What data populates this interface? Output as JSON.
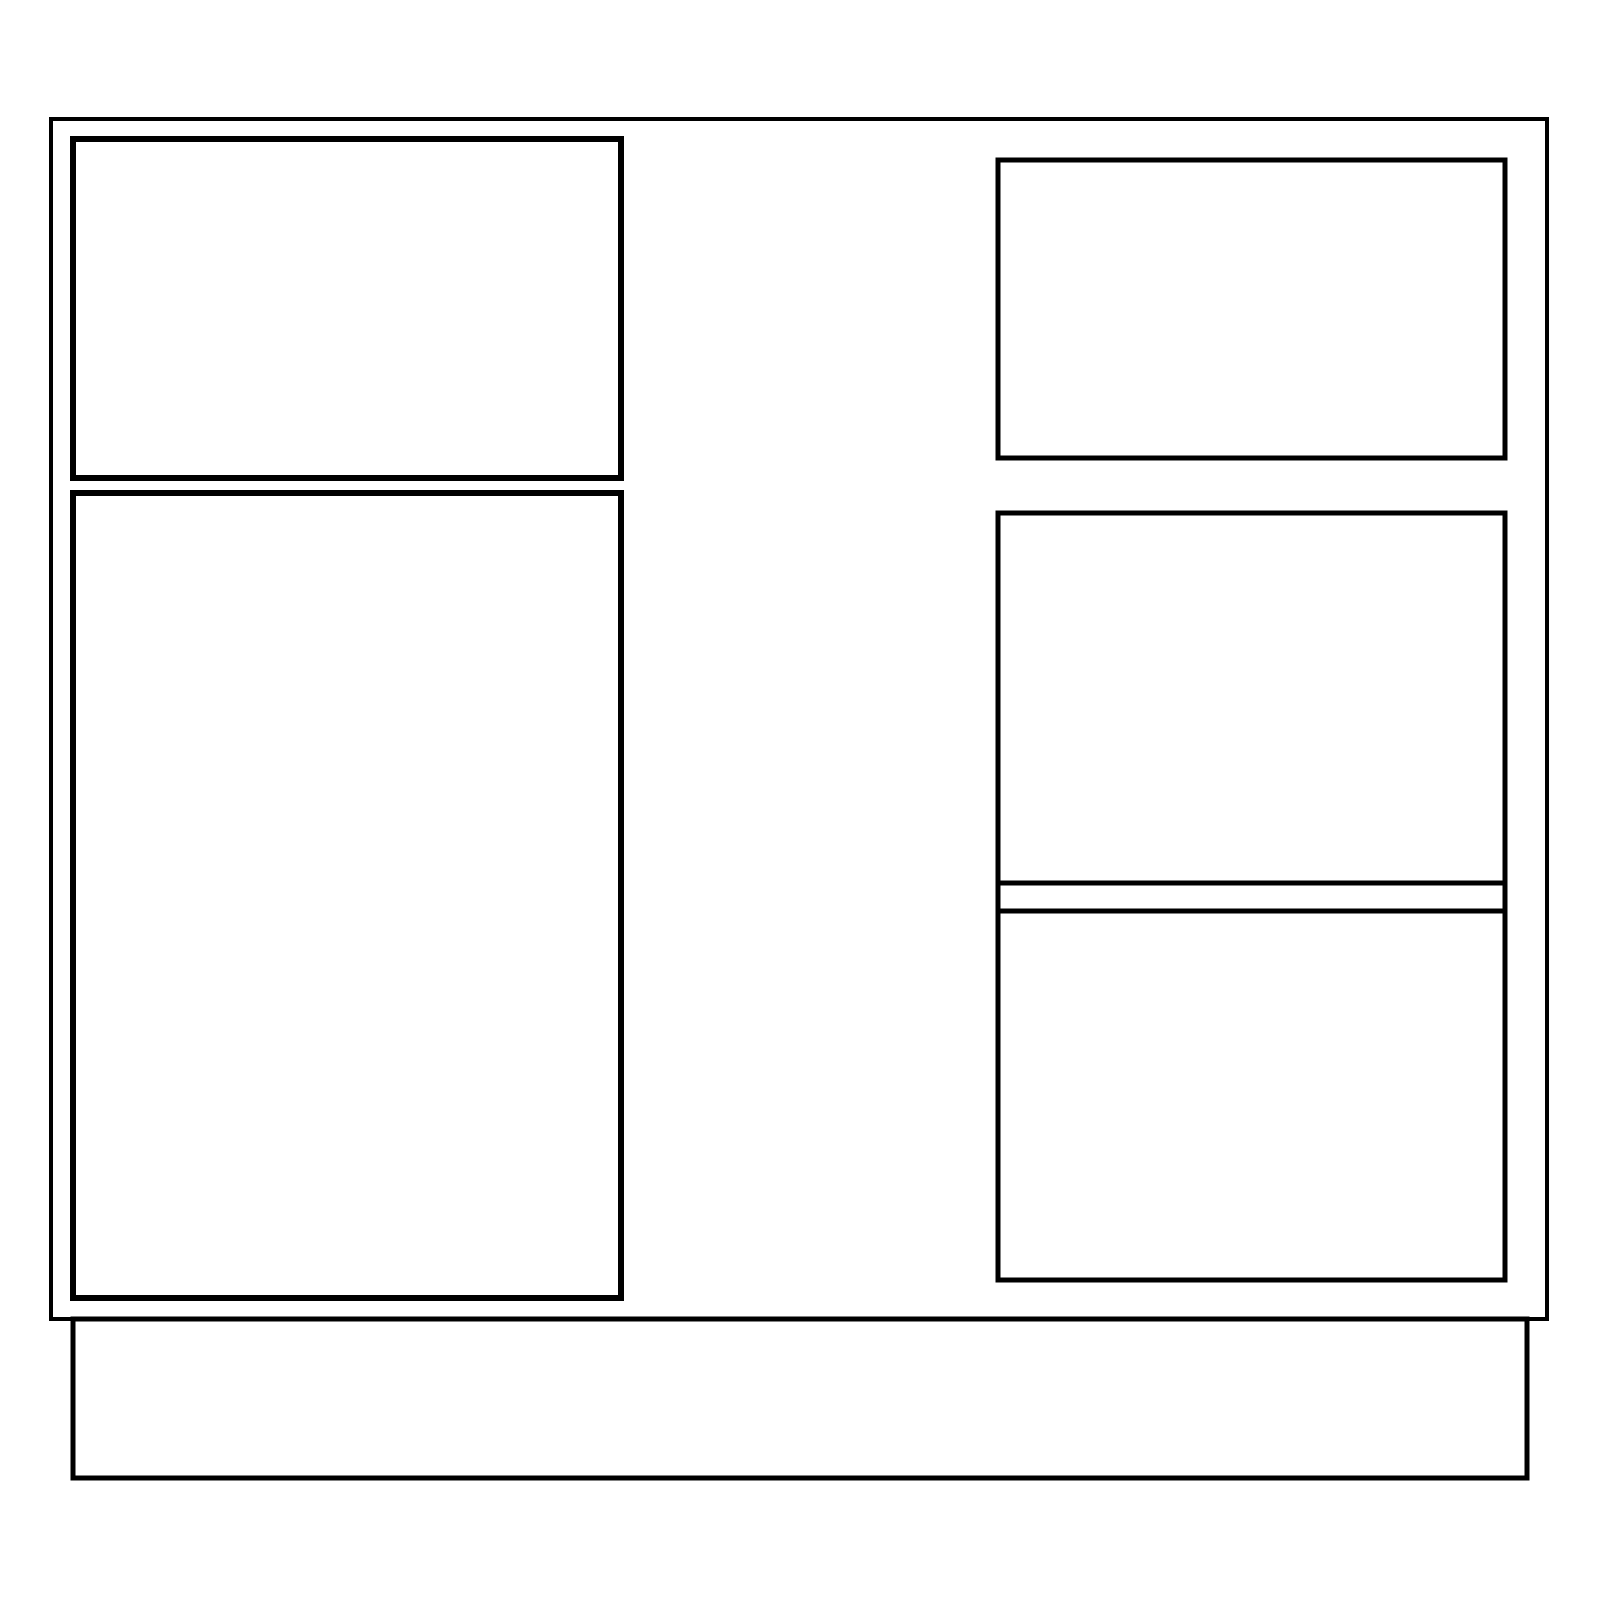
{
  "drawing": {
    "description_name": "cabinet-elevation-line-drawing",
    "background_color": "#ffffff",
    "stroke_color": "#000000",
    "canvas": {
      "width": 1600,
      "height": 1600
    },
    "shapes": [
      {
        "name": "cabinet-carcass-outline",
        "type": "rect",
        "x": 51,
        "y": 119,
        "w": 1496,
        "h": 1200,
        "stroke_width": 4
      },
      {
        "name": "toe-kick-base",
        "type": "rect",
        "x": 73,
        "y": 1319,
        "w": 1454,
        "h": 159,
        "stroke_width": 5
      },
      {
        "name": "left-drawer-front",
        "type": "rect",
        "x": 73,
        "y": 139,
        "w": 548,
        "h": 339,
        "stroke_width": 6
      },
      {
        "name": "left-door-panel",
        "type": "rect",
        "x": 73,
        "y": 493,
        "w": 548,
        "h": 805,
        "stroke_width": 6
      },
      {
        "name": "right-drawer-front-top",
        "type": "rect",
        "x": 998,
        "y": 160,
        "w": 507,
        "h": 298,
        "stroke_width": 5
      },
      {
        "name": "right-lower-panel-block",
        "type": "rect",
        "x": 998,
        "y": 513,
        "w": 507,
        "h": 767,
        "stroke_width": 5
      },
      {
        "name": "right-divider-rail-upper-line",
        "type": "hline",
        "x1": 998,
        "x2": 1505,
        "y": 883,
        "stroke_width": 5
      },
      {
        "name": "right-divider-rail-lower-line",
        "type": "hline",
        "x1": 998,
        "x2": 1505,
        "y": 911,
        "stroke_width": 5
      }
    ]
  }
}
